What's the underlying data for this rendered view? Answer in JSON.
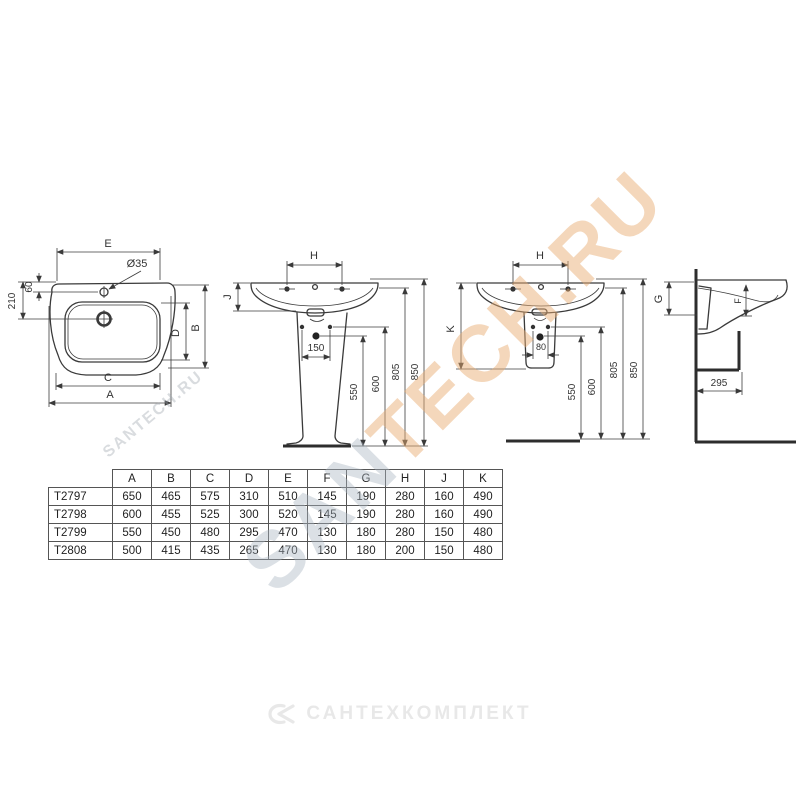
{
  "dims": {
    "e": "E",
    "dia35": "Ø35",
    "n60": "60",
    "n210": "210",
    "b": "B",
    "d": "D",
    "c": "C",
    "a": "A",
    "h": "H",
    "j": "J",
    "n150": "150",
    "n550": "550",
    "n600": "600",
    "n805": "805",
    "n850": "850",
    "k": "K",
    "n80": "80",
    "g": "G",
    "f": "F",
    "n295": "295"
  },
  "table": {
    "headers": [
      "A",
      "B",
      "C",
      "D",
      "E",
      "F",
      "G",
      "H",
      "J",
      "K"
    ],
    "rows": [
      {
        "model": "T2797",
        "values": [
          "650",
          "465",
          "575",
          "310",
          "510",
          "145",
          "190",
          "280",
          "160",
          "490"
        ]
      },
      {
        "model": "T2798",
        "values": [
          "600",
          "455",
          "525",
          "300",
          "520",
          "145",
          "190",
          "280",
          "160",
          "490"
        ]
      },
      {
        "model": "T2799",
        "values": [
          "550",
          "450",
          "480",
          "295",
          "470",
          "130",
          "180",
          "280",
          "150",
          "480"
        ]
      },
      {
        "model": "T2808",
        "values": [
          "500",
          "415",
          "435",
          "265",
          "470",
          "130",
          "180",
          "200",
          "150",
          "480"
        ]
      }
    ]
  },
  "watermark": {
    "big_gray": "SAN",
    "big_orange": "TECH.RU",
    "small": "SANTECH.RU"
  },
  "logo": {
    "text": "САНТЕХКОМПЛЕКТ"
  },
  "colors": {
    "line": "#3a3a3a",
    "watermark_orange": "#e9ac70",
    "watermark_gray": "#aab4c0",
    "logo_gray": "#e8e8e8"
  }
}
